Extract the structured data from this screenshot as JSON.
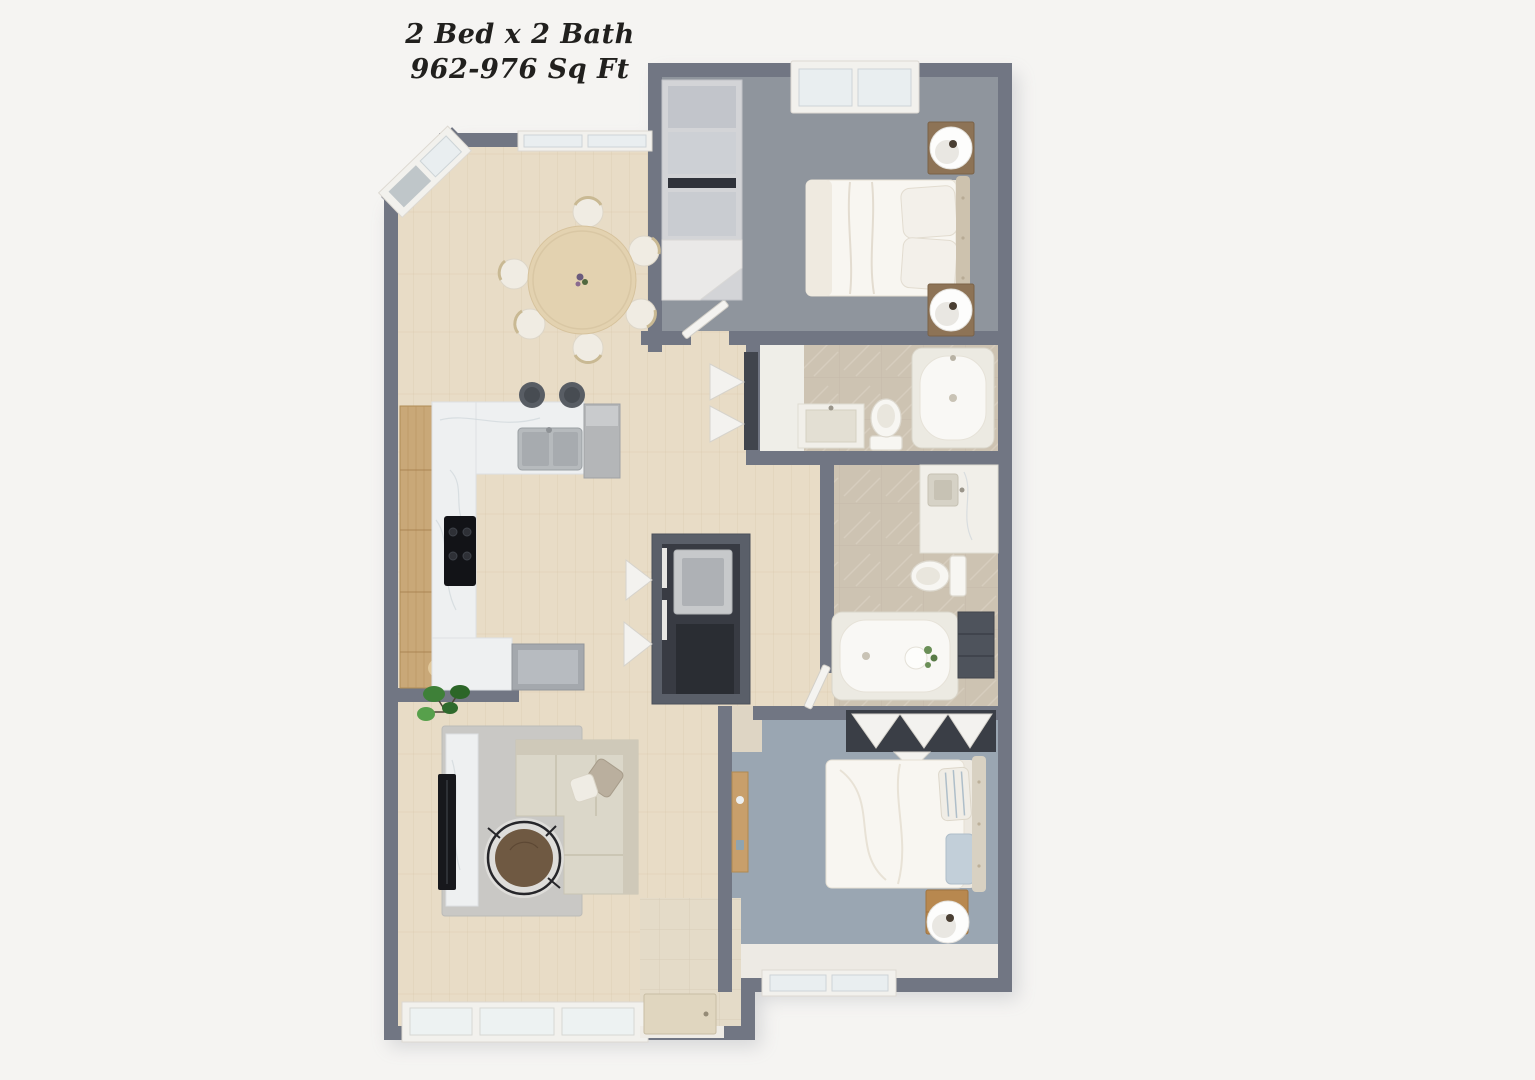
{
  "title": {
    "line1": "2 Bed x 2 Bath",
    "line2": "962-976 Sq Ft"
  },
  "summary": {
    "bedrooms": 2,
    "bathrooms": 2,
    "sqft_min": 962,
    "sqft_max": 976
  },
  "rooms": [
    "bedroom-1",
    "bedroom-2",
    "bathroom-1",
    "bathroom-2",
    "kitchen",
    "dining-area",
    "living-room",
    "laundry-closet",
    "linen-closet",
    "entry"
  ],
  "colors": {
    "background": "#f5f4f2",
    "wall": "#717683",
    "wall_dark": "#4b505b",
    "wood_floor": "#e8dcc6",
    "wood_plank_line": "#d2bf9f",
    "carpet_bedroom1": "#8f959d",
    "carpet_bedroom2": "#9aa6b2",
    "rug": "#c9c8c5",
    "tile_bath": "#cdc3b2",
    "tile_entry": "#e4dbc8",
    "marble_counter": "#eef0f1",
    "cabinet_wood": "#c9a878",
    "sofa": "#dbd7c9",
    "bed_linen": "#f8f6f1",
    "appliance_gray": "#a9adb2",
    "fixture_white": "#f7f6f2",
    "tv_black": "#17181c",
    "table_wood": "#e3d2b0",
    "coffee_table_wood": "#6f5942",
    "plant_green": "#3e8038",
    "door_beige": "#e0d6bf",
    "glass": "#e9eef0",
    "closet_dark": "#3a3e46",
    "title_color": "#21201e"
  }
}
